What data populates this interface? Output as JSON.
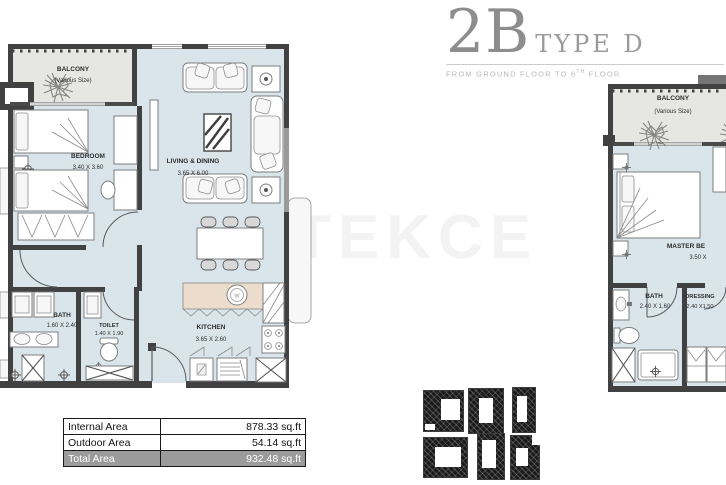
{
  "header": {
    "big": "2B",
    "type": "TYPE D",
    "subtitle_prefix": "FROM GROUND FLOOR TO 6",
    "subtitle_sup": "TH",
    "subtitle_suffix": " FLOOR"
  },
  "watermark": "TEKCE",
  "left_plan": {
    "balcony_label": "BALCONY",
    "balcony_size": "(Various Size)",
    "bedroom_label": "BEDROOM",
    "bedroom_dims": "3.40 X 3.60",
    "living_label": "LIVING & DINING",
    "living_dims": "3.65 X 6.00",
    "bath_label": "BATH",
    "bath_dims": "1.60 X 2.40",
    "toilet_label": "TOILET",
    "toilet_dims": "1.40 X 1.90",
    "kitchen_label": "KITCHEN",
    "kitchen_dims": "3.65 X 2.60",
    "sink_letter": "W"
  },
  "right_plan": {
    "balcony_label": "BALCONY",
    "balcony_size": "(Various Size)",
    "master_label": "MASTER BE",
    "master_dims": "3.50 X",
    "bath_label": "BATH",
    "bath_dims": "2.40 X 1.60",
    "dressing_label": "DRESSING",
    "dressing_dims": "2.40 X1.50"
  },
  "area_table": {
    "rows": [
      {
        "label": "Internal Area",
        "value": "878.33 sq.ft"
      },
      {
        "label": "Outdoor Area",
        "value": "54.14 sq.ft"
      },
      {
        "label": "Total Area",
        "value": "932.48 sq.ft"
      }
    ]
  },
  "colors": {
    "interior": "#d9e5eb",
    "balcony": "#e6e6e2",
    "wall": "#414141",
    "counter": "#ecdccb",
    "table_highlight": "#9b9b9b",
    "watermark": "#f3f3f3",
    "title_gray": "#8d8d8d"
  }
}
